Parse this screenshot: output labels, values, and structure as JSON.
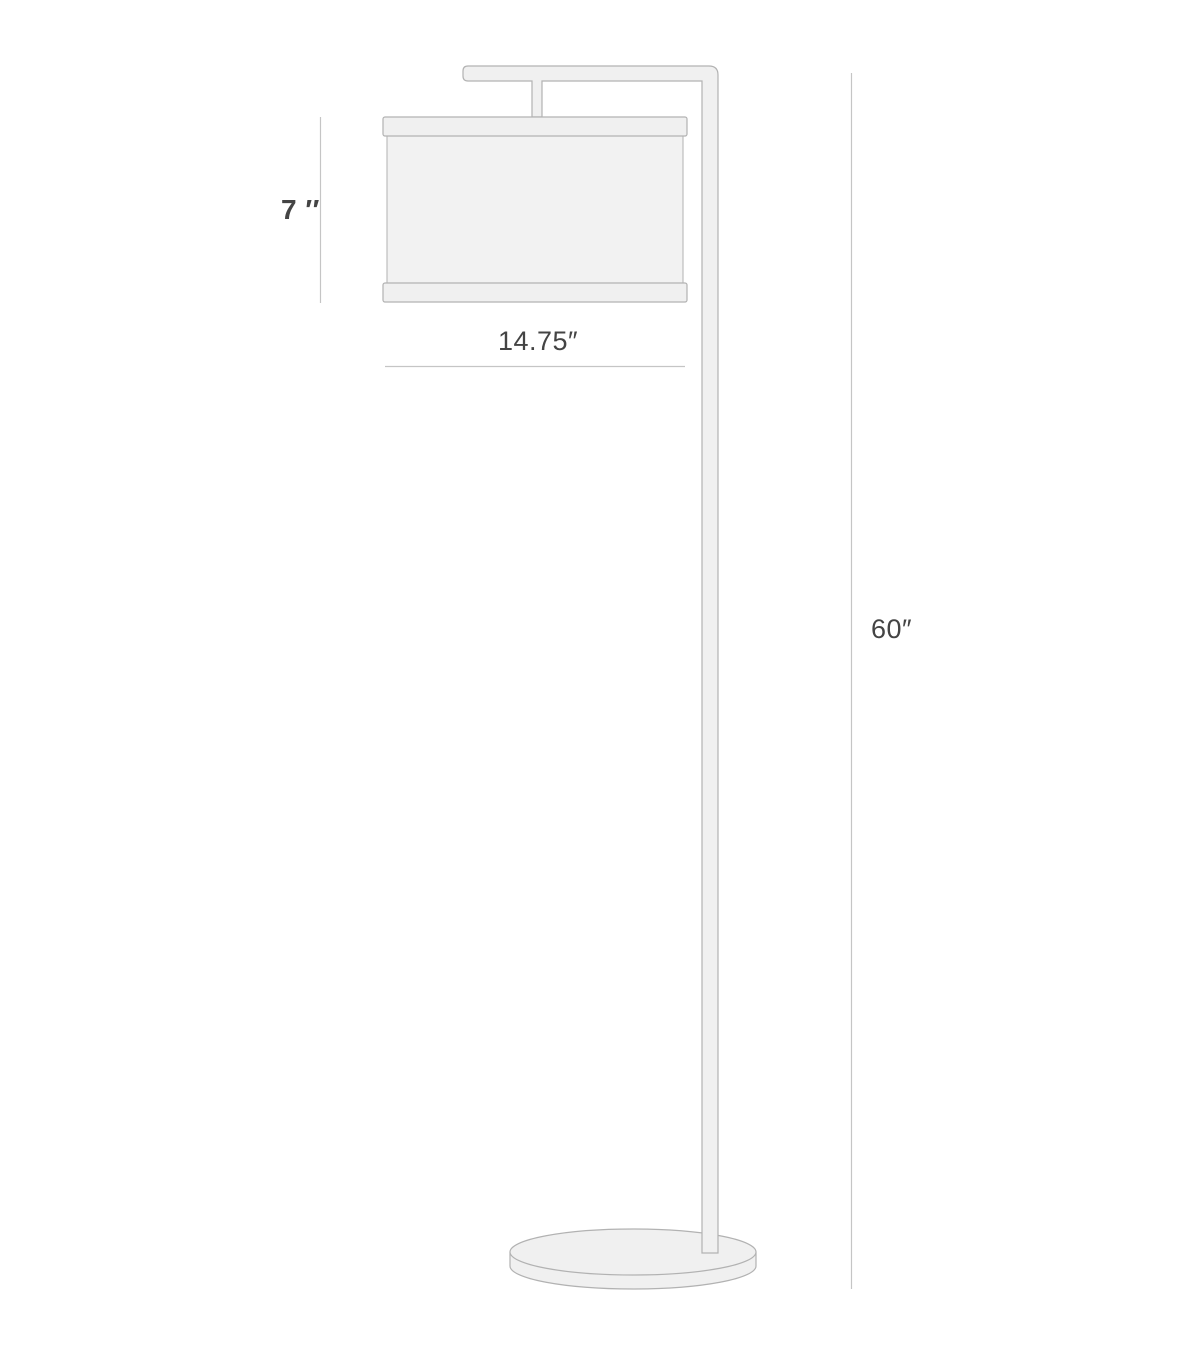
{
  "diagram": {
    "labels": {
      "shade_height": "7 ′′",
      "shade_width": "14.75″",
      "lamp_height": "60″"
    },
    "values": {
      "shade_height_inches": 7,
      "shade_width_inches": 14.75,
      "lamp_height_inches": 60,
      "unit": "inches"
    },
    "colors": {
      "background": "#ffffff",
      "lamp_fill": "#f0f0f0",
      "shade_fill": "#f2f2f2",
      "lamp_stroke": "#b2b2b2",
      "dimension_line": "#c5c5c5",
      "label_text": "#444444"
    }
  }
}
